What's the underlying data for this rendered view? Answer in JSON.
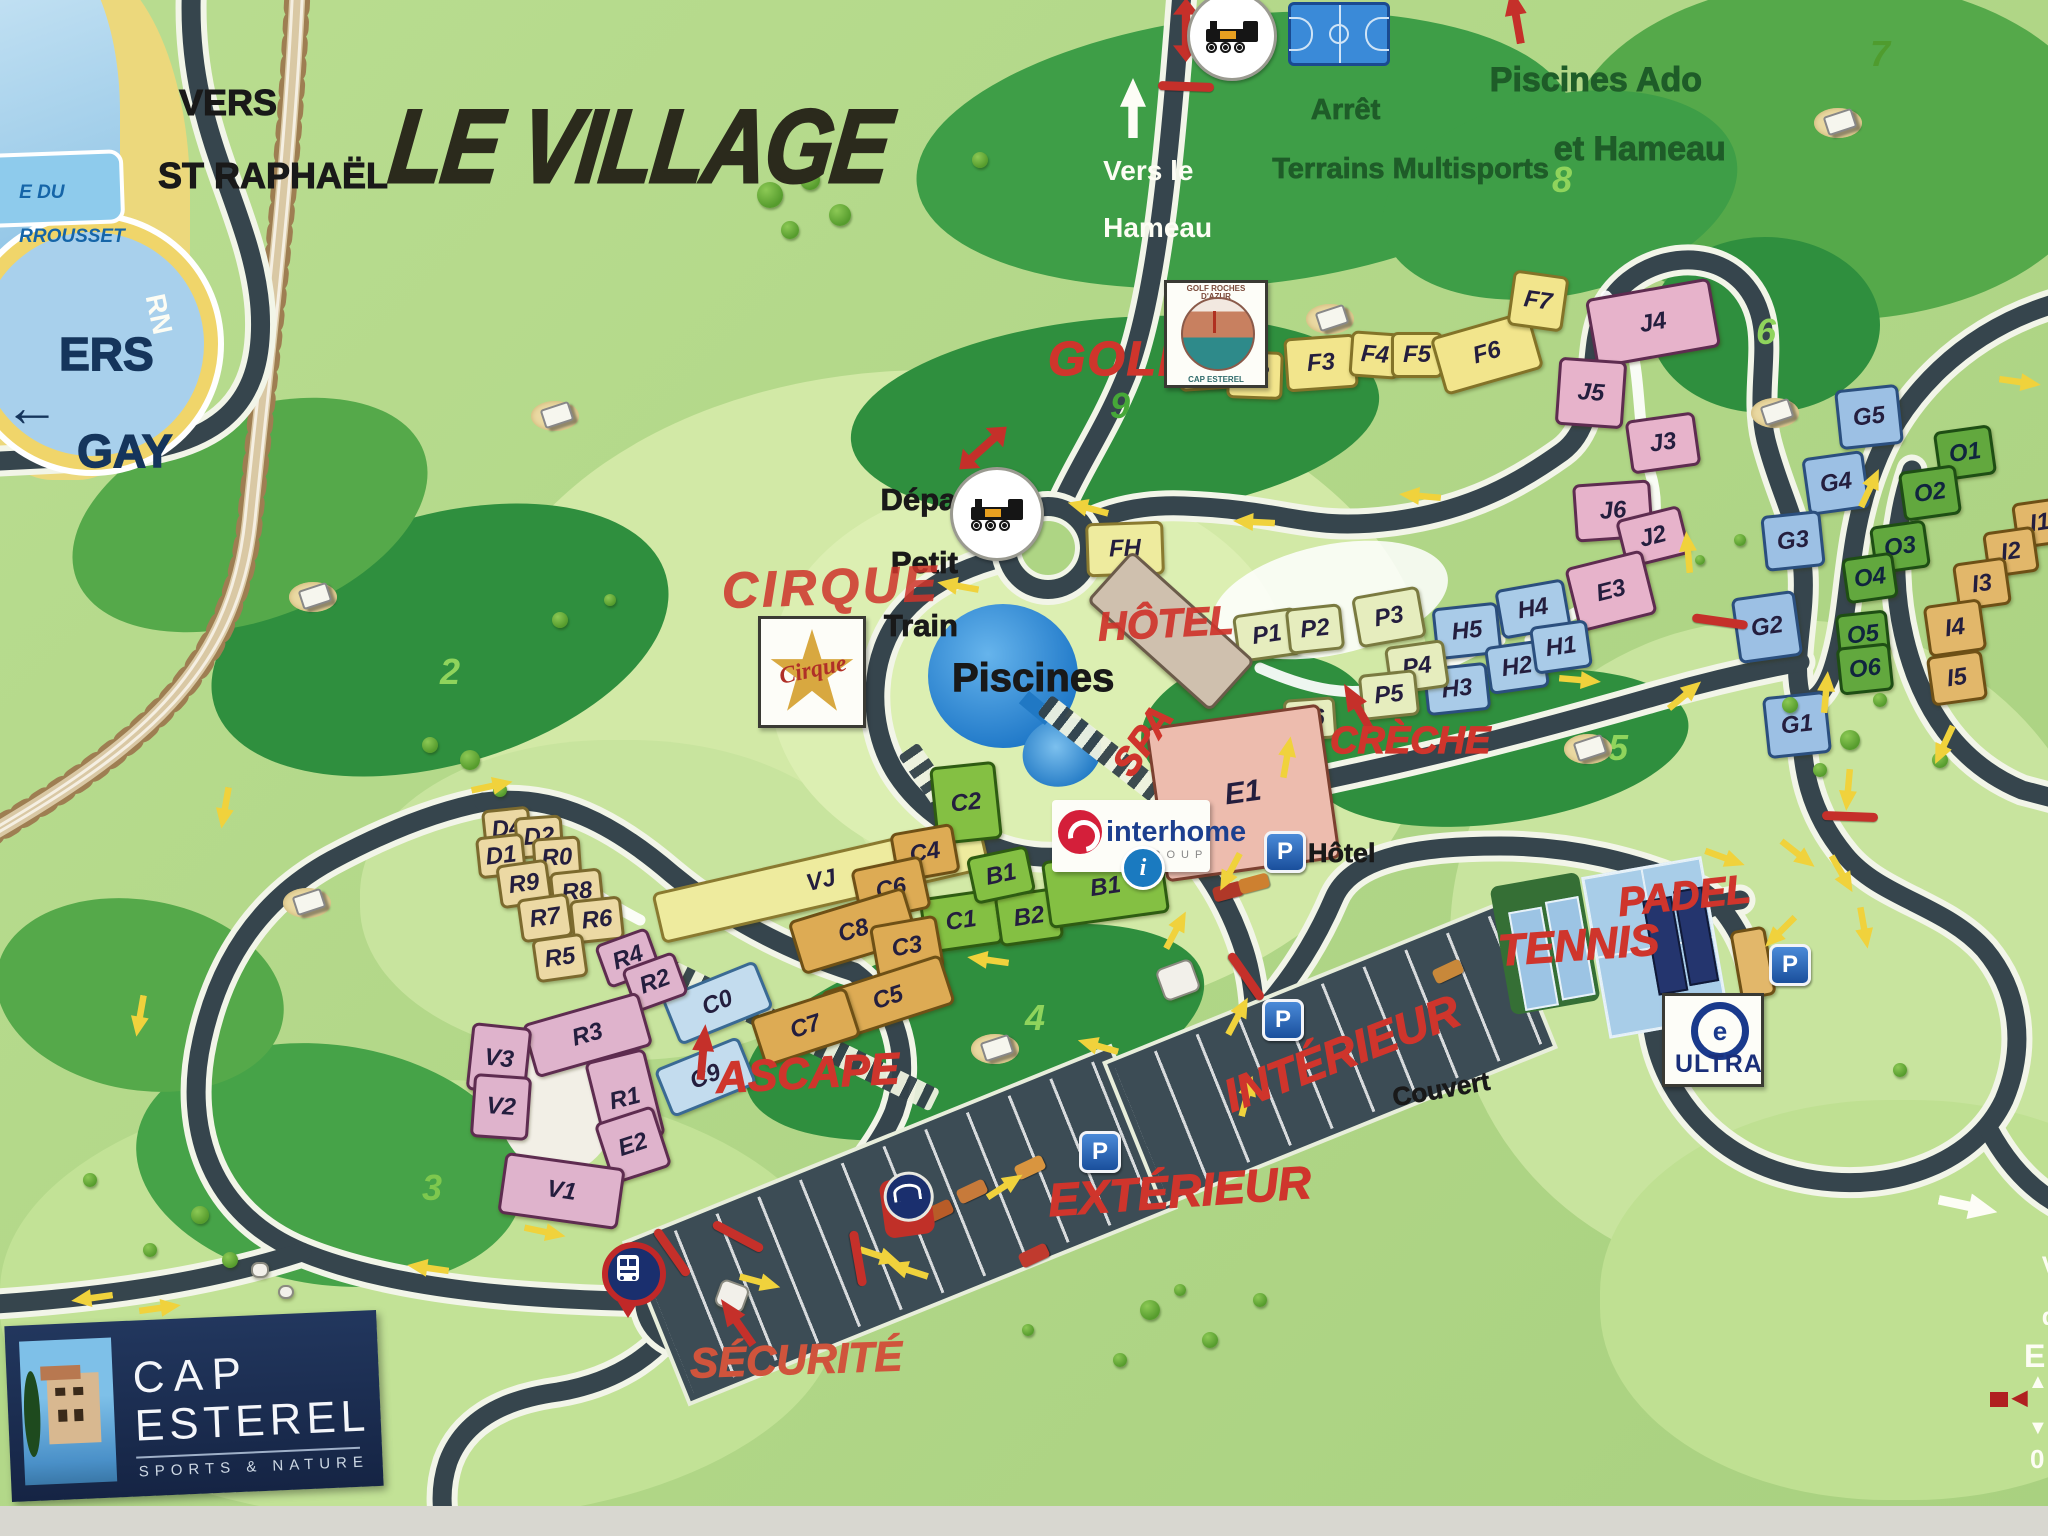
{
  "title": "LE VILLAGE",
  "directions": {
    "vers_st_raphael_l1": "VERS",
    "vers_st_raphael_l2": "ST RAPHAËL",
    "vers_agay_l1": "ERS",
    "vers_agay_l2": "GAY",
    "vers_agay_arrow": "←",
    "bubble_l1": "E DU",
    "bubble_l2": "RROUSSET",
    "rn": "RN",
    "vers_hameau_l1": "Vers le",
    "vers_hameau_l2": "Hameau",
    "arret_l1": "Arrêt",
    "arret_l2": "Terrains Multisports",
    "piscines_ado_l1": "Piscines Ado",
    "piscines_ado_l2": "et Hameau",
    "depart_l1": "Départ",
    "depart_l2": "Petit",
    "depart_l3": "Train"
  },
  "pois": {
    "golf": "GOLF",
    "cirque": "CIRQUE",
    "hotel": "HÔTEL",
    "spa": "SPA",
    "creche": "CRÈCHE",
    "piscines": "Piscines",
    "ascape": "ASCAPE",
    "securite": "SÉCURITÉ",
    "padel": "PADEL",
    "tennis": "TENNIS",
    "interieur": "INTÉRIEUR",
    "couvert": "Couvert",
    "exterieur": "EXTÉRIEUR",
    "p_hotel": "Hôtel",
    "p_letter": "P",
    "info_letter": "i"
  },
  "logos": {
    "cap_l1": "CAP",
    "cap_l2": "ESTEREL",
    "cap_sub": "SPORTS & NATURE",
    "interhome": "interhome",
    "interhome_sub": "GROUP",
    "ultra": "ULTRA",
    "ultra_e": "e",
    "golfclub_top": "GOLF ROCHES D'AZUR",
    "golfclub_bot": "CAP ESTEREL",
    "cirque_logo": "Cirque"
  },
  "edge_partial": {
    "l1": "Ve",
    "l2": "dé",
    "l3": "E",
    "l4": "0",
    "up": "▲",
    "down": "▼",
    "left": "◀"
  },
  "map": {
    "colors": {
      "road": "#36454d",
      "casing": "#f2f5e8",
      "arrow_yellow": "#f0d23c",
      "red": "#cf352c",
      "dark_green_text": "#1e5c28",
      "water": "#8ecbec",
      "beach": "#ecd87c",
      "navy_logo": "#1b2d52"
    },
    "light_patches": [
      [
        950,
        700,
        960,
        660,
        "#d2e9a6"
      ],
      [
        1780,
        950,
        660,
        660,
        "#c8e49e"
      ],
      [
        420,
        1300,
        840,
        440,
        "#c2e296"
      ],
      [
        620,
        900,
        520,
        320,
        "#c8e49e"
      ],
      [
        1030,
        680,
        520,
        400,
        "#dcefb2"
      ],
      [
        1900,
        1300,
        600,
        400,
        "#bfe092"
      ]
    ],
    "blobs": [
      [
        1245,
        150,
        660,
        270,
        -6,
        "#3e9e47"
      ],
      [
        1835,
        150,
        540,
        340,
        0,
        "#55a94a"
      ],
      [
        1560,
        195,
        360,
        200,
        -12,
        "#3e9e47"
      ],
      [
        1115,
        418,
        530,
        200,
        -5,
        "#2f8f3e"
      ],
      [
        1765,
        325,
        230,
        176,
        0,
        "#2f8f3e"
      ],
      [
        1500,
        748,
        380,
        150,
        -8,
        "#2f8f3e"
      ],
      [
        975,
        1032,
        470,
        190,
        -14,
        "#2f8f3e"
      ],
      [
        330,
        1165,
        390,
        240,
        8,
        "#46a348"
      ],
      [
        440,
        640,
        470,
        250,
        -16,
        "#2f8f3e"
      ],
      [
        250,
        515,
        370,
        210,
        -20,
        "#55a94a"
      ],
      [
        140,
        995,
        290,
        190,
        10,
        "#55a94a"
      ],
      [
        1255,
        725,
        230,
        140,
        -10,
        "#2f8f3e"
      ]
    ],
    "holes": [
      [
        "2",
        450,
        672,
        "#8fd45c"
      ],
      [
        "3",
        432,
        1188,
        "#7ec84e"
      ],
      [
        "4",
        1035,
        1018,
        "#8fd45c"
      ],
      [
        "5",
        1618,
        748,
        "#8fd45c"
      ],
      [
        "6",
        1766,
        332,
        "#8fd45c"
      ],
      [
        "7",
        1880,
        54,
        "#4f9c2e"
      ],
      [
        "8",
        1562,
        180,
        "#8fd45c"
      ],
      [
        "9",
        1120,
        406,
        "#46a838"
      ]
    ],
    "buildings": [
      [
        "F1",
        1205,
        362,
        54,
        44,
        -4,
        "f"
      ],
      [
        "F2",
        1252,
        372,
        50,
        42,
        2,
        "f"
      ],
      [
        "F3",
        1318,
        360,
        66,
        48,
        -4,
        "f"
      ],
      [
        "F4",
        1372,
        352,
        44,
        40,
        4,
        "f"
      ],
      [
        "F5",
        1414,
        352,
        46,
        40,
        0,
        "f"
      ],
      [
        "F6",
        1484,
        350,
        96,
        54,
        -16,
        "f"
      ],
      [
        "F7",
        1535,
        298,
        50,
        50,
        8,
        "f"
      ],
      [
        "FH",
        1122,
        546,
        72,
        48,
        -2,
        "fy"
      ],
      [
        "VJ",
        818,
        878,
        330,
        46,
        -13,
        "fy"
      ],
      [
        "J4",
        1650,
        320,
        120,
        64,
        -10,
        "j"
      ],
      [
        "J5",
        1588,
        390,
        62,
        62,
        4,
        "j"
      ],
      [
        "J3",
        1660,
        440,
        64,
        48,
        -8,
        "j"
      ],
      [
        "J6",
        1610,
        508,
        72,
        52,
        -4,
        "j"
      ],
      [
        "J2",
        1650,
        534,
        60,
        44,
        -14,
        "j"
      ],
      [
        "E3",
        1608,
        588,
        74,
        60,
        -14,
        "j"
      ],
      [
        "H5",
        1464,
        628,
        60,
        46,
        -6,
        "h"
      ],
      [
        "H4",
        1530,
        606,
        64,
        44,
        -10,
        "h"
      ],
      [
        "H3",
        1454,
        686,
        58,
        42,
        -6,
        "h"
      ],
      [
        "H2",
        1514,
        664,
        54,
        42,
        -8,
        "h"
      ],
      [
        "H1",
        1558,
        644,
        52,
        42,
        -8,
        "h"
      ],
      [
        "P1",
        1264,
        632,
        58,
        42,
        -8,
        "p"
      ],
      [
        "P2",
        1312,
        626,
        50,
        40,
        -6,
        "p"
      ],
      [
        "P3",
        1386,
        614,
        62,
        46,
        -10,
        "p"
      ],
      [
        "P4",
        1414,
        664,
        54,
        42,
        -8,
        "p"
      ],
      [
        "P5",
        1386,
        692,
        52,
        40,
        -6,
        "p"
      ],
      [
        "P6",
        1307,
        716,
        46,
        36,
        -4,
        "p"
      ],
      [
        "",
        1168,
        628,
        160,
        62,
        42,
        "hot"
      ],
      [
        "E1",
        1240,
        790,
        170,
        150,
        -8,
        "e1",
        30
      ],
      [
        "C2",
        963,
        800,
        60,
        72,
        -6,
        "gn"
      ],
      [
        "C1",
        958,
        918,
        72,
        50,
        -8,
        "gn"
      ],
      [
        "B2",
        1026,
        914,
        58,
        46,
        -8,
        "gn"
      ],
      [
        "B1",
        998,
        872,
        56,
        42,
        -12,
        "gn"
      ],
      [
        "B1",
        1102,
        884,
        115,
        62,
        -8,
        "gn"
      ],
      [
        "C4",
        922,
        850,
        58,
        44,
        -10,
        "ct"
      ],
      [
        "C6",
        888,
        886,
        66,
        48,
        -12,
        "ct"
      ],
      [
        "C8",
        850,
        928,
        115,
        50,
        -17,
        "ct"
      ],
      [
        "C3",
        904,
        944,
        62,
        48,
        -10,
        "ct"
      ],
      [
        "C5",
        885,
        995,
        120,
        46,
        -18,
        "ct"
      ],
      [
        "C7",
        802,
        1024,
        95,
        46,
        -18,
        "ct"
      ],
      [
        "C0",
        714,
        1000,
        95,
        46,
        -22,
        "cb"
      ],
      [
        "C9",
        702,
        1074,
        85,
        46,
        -22,
        "cb"
      ],
      [
        "D4",
        504,
        826,
        42,
        36,
        -6,
        "dt"
      ],
      [
        "D2",
        536,
        834,
        42,
        36,
        -4,
        "dt"
      ],
      [
        "D1",
        498,
        853,
        42,
        36,
        -6,
        "dt"
      ],
      [
        "R0",
        554,
        855,
        42,
        36,
        -4,
        "dt"
      ],
      [
        "R9",
        521,
        881,
        46,
        38,
        -8,
        "dt"
      ],
      [
        "R8",
        574,
        889,
        46,
        38,
        -6,
        "dt"
      ],
      [
        "R7",
        542,
        915,
        46,
        38,
        -8,
        "dt"
      ],
      [
        "R6",
        594,
        917,
        46,
        38,
        -6,
        "dt"
      ],
      [
        "R5",
        557,
        955,
        46,
        38,
        -8,
        "dt"
      ],
      [
        "R4",
        625,
        955,
        50,
        40,
        -20,
        "v"
      ],
      [
        "R2",
        652,
        979,
        50,
        40,
        -20,
        "v"
      ],
      [
        "R3",
        584,
        1032,
        115,
        50,
        -16,
        "v"
      ],
      [
        "V3",
        496,
        1056,
        54,
        62,
        6,
        "v"
      ],
      [
        "V2",
        498,
        1104,
        52,
        58,
        4,
        "v"
      ],
      [
        "R1",
        622,
        1096,
        56,
        84,
        -14,
        "v"
      ],
      [
        "E2",
        630,
        1142,
        56,
        58,
        -18,
        "v"
      ],
      [
        "V1",
        558,
        1188,
        115,
        56,
        8,
        "v"
      ],
      [
        "G5",
        1866,
        414,
        58,
        54,
        -6,
        "gb"
      ],
      [
        "G4",
        1833,
        480,
        56,
        52,
        -8,
        "gb"
      ],
      [
        "G3",
        1790,
        538,
        54,
        50,
        -6,
        "gb"
      ],
      [
        "G2",
        1764,
        624,
        58,
        60,
        -8,
        "gb"
      ],
      [
        "G1",
        1794,
        722,
        58,
        56,
        -6,
        "gb"
      ],
      [
        "O1",
        1962,
        450,
        52,
        44,
        -8,
        "o"
      ],
      [
        "O2",
        1927,
        490,
        52,
        44,
        -8,
        "o"
      ],
      [
        "O3",
        1897,
        544,
        50,
        42,
        -8,
        "o"
      ],
      [
        "O4",
        1867,
        575,
        46,
        40,
        -8,
        "o"
      ],
      [
        "O5",
        1860,
        632,
        46,
        40,
        -6,
        "o"
      ],
      [
        "O6",
        1862,
        666,
        48,
        42,
        -6,
        "o"
      ],
      [
        "I1",
        2037,
        520,
        46,
        40,
        -8,
        "i"
      ],
      [
        "I2",
        2008,
        549,
        46,
        40,
        -8,
        "i"
      ],
      [
        "I3",
        1979,
        581,
        48,
        42,
        -8,
        "i"
      ],
      [
        "I4",
        1952,
        625,
        52,
        46,
        -8,
        "i"
      ],
      [
        "I5",
        1954,
        675,
        50,
        44,
        -8,
        "i"
      ],
      [
        "",
        1750,
        960,
        30,
        64,
        -10,
        "i"
      ],
      [
        "",
        1176,
        978,
        34,
        30,
        -20,
        "wh"
      ],
      [
        "",
        730,
        1294,
        26,
        24,
        20,
        "wh"
      ],
      [
        "",
        258,
        1268,
        14,
        12,
        0,
        "wh"
      ],
      [
        "",
        284,
        1290,
        12,
        10,
        0,
        "wh"
      ]
    ],
    "arrows_yellow": [
      [
        82,
        424,
        18
      ],
      [
        126,
        400,
        205
      ],
      [
        958,
        586,
        190
      ],
      [
        1088,
        508,
        195
      ],
      [
        1254,
        522,
        183
      ],
      [
        1420,
        496,
        185
      ],
      [
        1688,
        552,
        -95
      ],
      [
        2020,
        382,
        8
      ],
      [
        1870,
        488,
        -65
      ],
      [
        1580,
        680,
        5
      ],
      [
        1685,
        695,
        -40
      ],
      [
        1826,
        692,
        -85
      ],
      [
        1848,
        790,
        95
      ],
      [
        1944,
        745,
        115
      ],
      [
        1725,
        858,
        20
      ],
      [
        1798,
        854,
        38
      ],
      [
        1842,
        874,
        60
      ],
      [
        1864,
        928,
        80
      ],
      [
        1780,
        932,
        135
      ],
      [
        1287,
        757,
        -80
      ],
      [
        1230,
        872,
        118
      ],
      [
        1176,
        930,
        -62
      ],
      [
        1098,
        1046,
        196
      ],
      [
        988,
        960,
        188
      ],
      [
        1238,
        1016,
        -62
      ],
      [
        1247,
        1096,
        -75
      ],
      [
        880,
        1256,
        18
      ],
      [
        908,
        1270,
        198
      ],
      [
        1005,
        1186,
        -33
      ],
      [
        760,
        1282,
        15
      ],
      [
        545,
        1232,
        12
      ],
      [
        428,
        1268,
        188
      ],
      [
        140,
        1016,
        100
      ],
      [
        92,
        1298,
        172
      ],
      [
        160,
        1308,
        352
      ],
      [
        225,
        808,
        100
      ],
      [
        492,
        786,
        -12
      ]
    ],
    "arrows_white": [
      [
        1133,
        108,
        -90
      ],
      [
        1968,
        1206,
        12
      ]
    ],
    "arrows_red": [
      [
        1516,
        16,
        -100
      ],
      [
        1358,
        708,
        -120
      ],
      [
        703,
        1052,
        -85
      ],
      [
        737,
        1322,
        -125
      ]
    ],
    "arrows_red_double": [
      [
        1186,
        30,
        0
      ],
      [
        983,
        448,
        48
      ]
    ],
    "barriers": [
      [
        1186,
        86,
        2
      ],
      [
        1246,
        976,
        55
      ],
      [
        1850,
        816,
        2
      ],
      [
        1720,
        621,
        8
      ],
      [
        672,
        1252,
        55
      ],
      [
        738,
        1236,
        28
      ],
      [
        858,
        1258,
        80
      ]
    ],
    "carts": [
      [
        555,
        415
      ],
      [
        313,
        596
      ],
      [
        1330,
        318
      ],
      [
        1838,
        122
      ],
      [
        1775,
        412
      ],
      [
        1588,
        748
      ],
      [
        995,
        1048
      ],
      [
        307,
        902
      ]
    ],
    "bushes": [
      [
        770,
        195,
        26
      ],
      [
        810,
        180,
        20
      ],
      [
        840,
        215,
        22
      ],
      [
        790,
        230,
        18
      ],
      [
        980,
        160,
        16
      ],
      [
        430,
        745,
        16
      ],
      [
        470,
        760,
        20
      ],
      [
        500,
        790,
        14
      ],
      [
        560,
        620,
        16
      ],
      [
        610,
        600,
        12
      ],
      [
        200,
        1215,
        18
      ],
      [
        150,
        1250,
        14
      ],
      [
        230,
        1260,
        16
      ],
      [
        90,
        1180,
        14
      ],
      [
        1790,
        705,
        16
      ],
      [
        1850,
        740,
        20
      ],
      [
        1880,
        700,
        14
      ],
      [
        1940,
        760,
        16
      ],
      [
        1820,
        770,
        14
      ],
      [
        1150,
        1310,
        20
      ],
      [
        1210,
        1340,
        16
      ],
      [
        1260,
        1300,
        14
      ],
      [
        1120,
        1360,
        14
      ],
      [
        1028,
        1330,
        12
      ],
      [
        1180,
        1290,
        12
      ],
      [
        1740,
        540,
        12
      ],
      [
        1700,
        560,
        10
      ],
      [
        260,
        1395,
        16
      ],
      [
        320,
        1420,
        12
      ],
      [
        1900,
        1070,
        14
      ]
    ],
    "cars": [
      [
        938,
        1212,
        -25,
        "#b85c28"
      ],
      [
        972,
        1192,
        -25,
        "#c77a3a"
      ],
      [
        1030,
        1168,
        -25,
        "#d9953f"
      ],
      [
        1034,
        1256,
        -25,
        "#c03a2e"
      ],
      [
        1228,
        892,
        -15,
        "#b03828"
      ],
      [
        1254,
        884,
        -15,
        "#cd8030"
      ],
      [
        1448,
        972,
        -25,
        "#c8883a"
      ]
    ],
    "p_signs": [
      [
        1285,
        852
      ],
      [
        1283,
        1020
      ],
      [
        1100,
        1152
      ],
      [
        1790,
        965
      ]
    ],
    "hatches": [
      [
        1135,
        775,
        230,
        38
      ],
      [
        800,
        1035,
        300,
        26
      ],
      [
        928,
        778,
        70,
        55
      ]
    ]
  }
}
